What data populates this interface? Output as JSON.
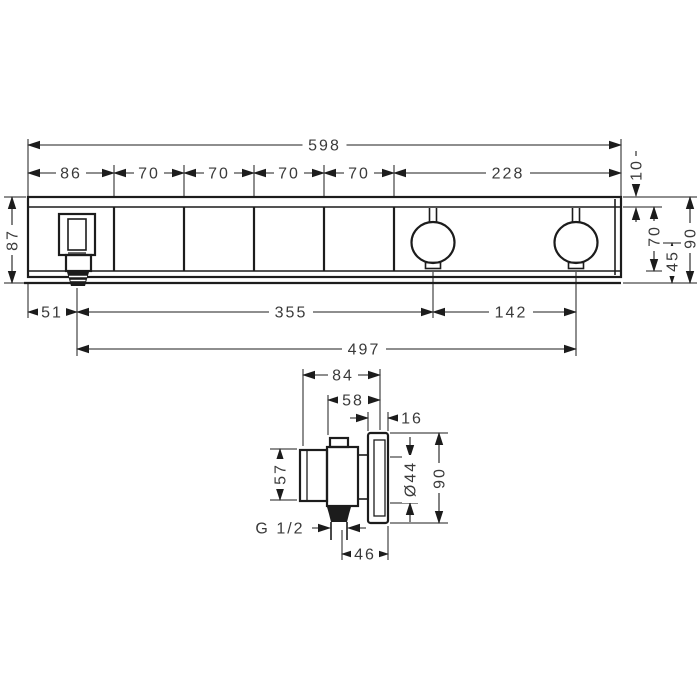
{
  "colors": {
    "background": "#ffffff",
    "line": "#1c1c1c",
    "text": "#3a3a3a"
  },
  "front_view": {
    "total_width": "598",
    "segments": [
      "86",
      "70",
      "70",
      "70",
      "70",
      "228"
    ],
    "height_left": "87",
    "top_plate_lip": "10",
    "body_inner_height": "70",
    "center_to_bottom": "45",
    "total_height_right": "90",
    "edge_to_handle_center": "51",
    "handle_to_first_knob": "355",
    "knob_spacing": "142",
    "handle_to_second_knob": "497"
  },
  "side_view": {
    "total_depth": "84",
    "cartridge_depth": "58",
    "plate_thickness": "16",
    "body_height": "57",
    "cartridge_diameter": "Ø44",
    "plate_height": "90",
    "thread_size": "G 1/2",
    "axis_to_plate_front": "46"
  }
}
